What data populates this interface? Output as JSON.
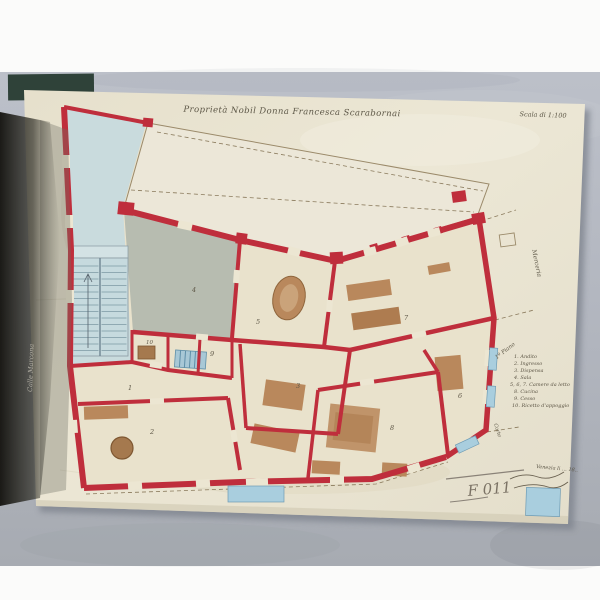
{
  "title": "Proprietà Nobil Donna Francesca Scarabornai",
  "scale_note": "Scala di 1:100",
  "legend": {
    "header": "1º Piano",
    "items": [
      "1. Andito",
      "2. Ingresso",
      "3. Dispensa",
      "4. Sala",
      "5, 6, 7. Camere da letto",
      "8. Cucina",
      "9. Cesso",
      "10. Ricetto d'appoggio"
    ]
  },
  "street_labels": {
    "left": "Calle Marcona",
    "right": "Merceria",
    "corner": "Corte"
  },
  "annotations": {
    "pencil_mark": "F 011",
    "date_line": "Venezia li … 18.."
  },
  "plan": {
    "room_numbers": [
      "1",
      "2",
      "3",
      "4",
      "5",
      "6",
      "7",
      "8",
      "9",
      "10"
    ]
  },
  "colors": {
    "wall_red": "#bf2e3c",
    "courtyard_blue": "#c6dade",
    "room_gray": "#b4b9ae",
    "furniture_tan": "#b9885c",
    "paper_cream": "#e9e4d2",
    "backdrop_gray": "#b4b8c1",
    "window_blue": "#a9cede",
    "shadow_dark": "#17160f"
  }
}
